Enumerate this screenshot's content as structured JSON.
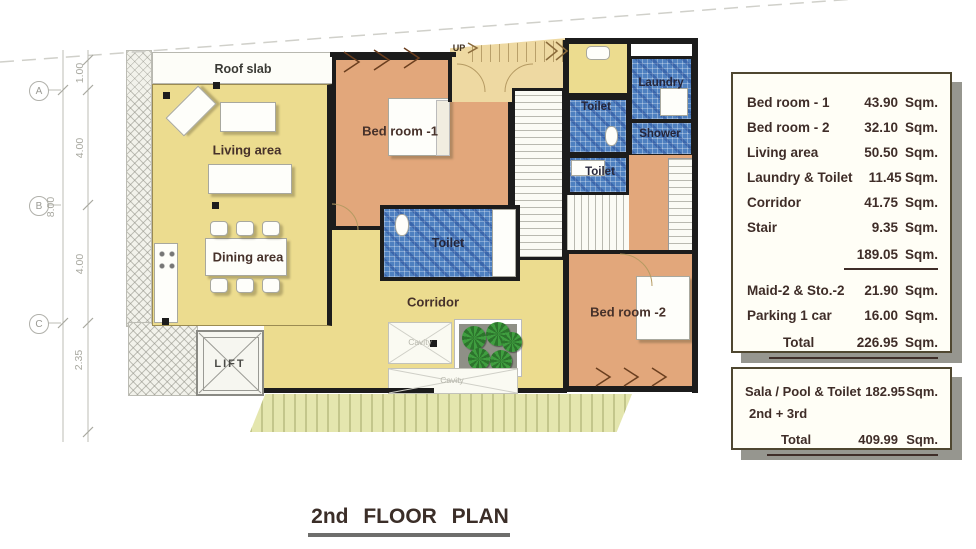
{
  "title": {
    "text": "2nd FLOOR PLAN"
  },
  "plan": {
    "labels": {
      "roof_slab": "Roof slab",
      "living": "Living area",
      "dining": "Dining area",
      "bedroom1": "Bed room -1",
      "bedroom2": "Bed room -2",
      "toilet_center": "Toilet",
      "toilet_top": "Toilet",
      "toilet_mid": "Toilet",
      "laundry": "Laundry",
      "shower": "Shower",
      "corridor": "Corridor",
      "lift": "LIFT",
      "up": "UP",
      "cavity_a": "Cavity",
      "cavity_b": "Cavity"
    },
    "grid": {
      "letters": [
        "A",
        "B",
        "C"
      ],
      "segments": [
        "1.00",
        "4.00",
        "4.00",
        "2.35"
      ],
      "overall": "8.00"
    },
    "colors": {
      "floor_yellow": "#ecdc8f",
      "bedroom_salmon": "#e2a77b",
      "wet_tile_blue": "#4e80c0",
      "stair_tan": "#eed9a2",
      "deck_green": "#e4e6ae",
      "wall_black": "#1c1c1c",
      "table_border": "#4f4730",
      "table_text": "#3f2d28"
    }
  },
  "tables": {
    "main": {
      "rows": [
        {
          "label": "Bed room - 1",
          "value": "43.90",
          "unit": "Sqm."
        },
        {
          "label": "Bed room - 2",
          "value": "32.10",
          "unit": "Sqm."
        },
        {
          "label": "Living area",
          "value": "50.50",
          "unit": "Sqm."
        },
        {
          "label": "Laundry & Toilet",
          "value": "11.45",
          "unit": "Sqm."
        },
        {
          "label": "Corridor",
          "value": "41.75",
          "unit": "Sqm."
        },
        {
          "label": "Stair",
          "value": "9.35",
          "unit": "Sqm."
        }
      ],
      "subtotal": {
        "value": "189.05",
        "unit": "Sqm."
      },
      "rows2": [
        {
          "label": "Maid-2 & Sto.-2",
          "value": "21.90",
          "unit": "Sqm."
        },
        {
          "label": "Parking 1 car",
          "value": "16.00",
          "unit": "Sqm."
        }
      ],
      "total": {
        "label": "Total",
        "value": "226.95",
        "unit": "Sqm."
      }
    },
    "secondary": {
      "row": {
        "label": "Sala / Pool & Toilet",
        "value": "182.95",
        "unit": "Sqm."
      },
      "note": "2nd + 3rd",
      "total": {
        "label": "Total",
        "value": "409.99",
        "unit": "Sqm."
      }
    }
  }
}
